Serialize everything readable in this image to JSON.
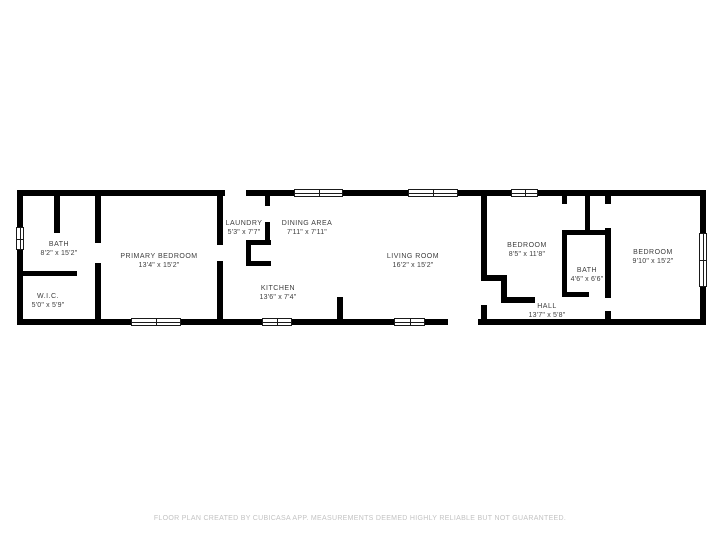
{
  "colors": {
    "wall": "#000000",
    "room_label_text": "#3d3d3d",
    "footer_text": "#c3c3c3",
    "window_fill": "#ffffff",
    "background": "#ffffff"
  },
  "rooms": [
    {
      "name": "BATH",
      "dims": "8'2\" x 15'2\""
    },
    {
      "name": "W.I.C.",
      "dims": "5'0\" x 5'9\""
    },
    {
      "name": "PRIMARY BEDROOM",
      "dims": "13'4\" x 15'2\""
    },
    {
      "name": "LAUNDRY",
      "dims": "5'3\" x 7'7\""
    },
    {
      "name": "DINING AREA",
      "dims": "7'11\" x 7'11\""
    },
    {
      "name": "KITCHEN",
      "dims": "13'6\" x 7'4\""
    },
    {
      "name": "LIVING ROOM",
      "dims": "16'2\" x 15'2\""
    },
    {
      "name": "BEDROOM",
      "dims": "8'5\" x 11'8\""
    },
    {
      "name": "BATH",
      "dims": "4'6\" x 6'6\""
    },
    {
      "name": "HALL",
      "dims": "13'7\" x 5'8\""
    },
    {
      "name": "BEDROOM",
      "dims": "9'10\" x 15'2\""
    }
  ],
  "footer": {
    "disclaimer": "FLOOR PLAN CREATED BY CUBICASA APP. MEASUREMENTS DEEMED HIGHLY RELIABLE BUT NOT GUARANTEED."
  }
}
